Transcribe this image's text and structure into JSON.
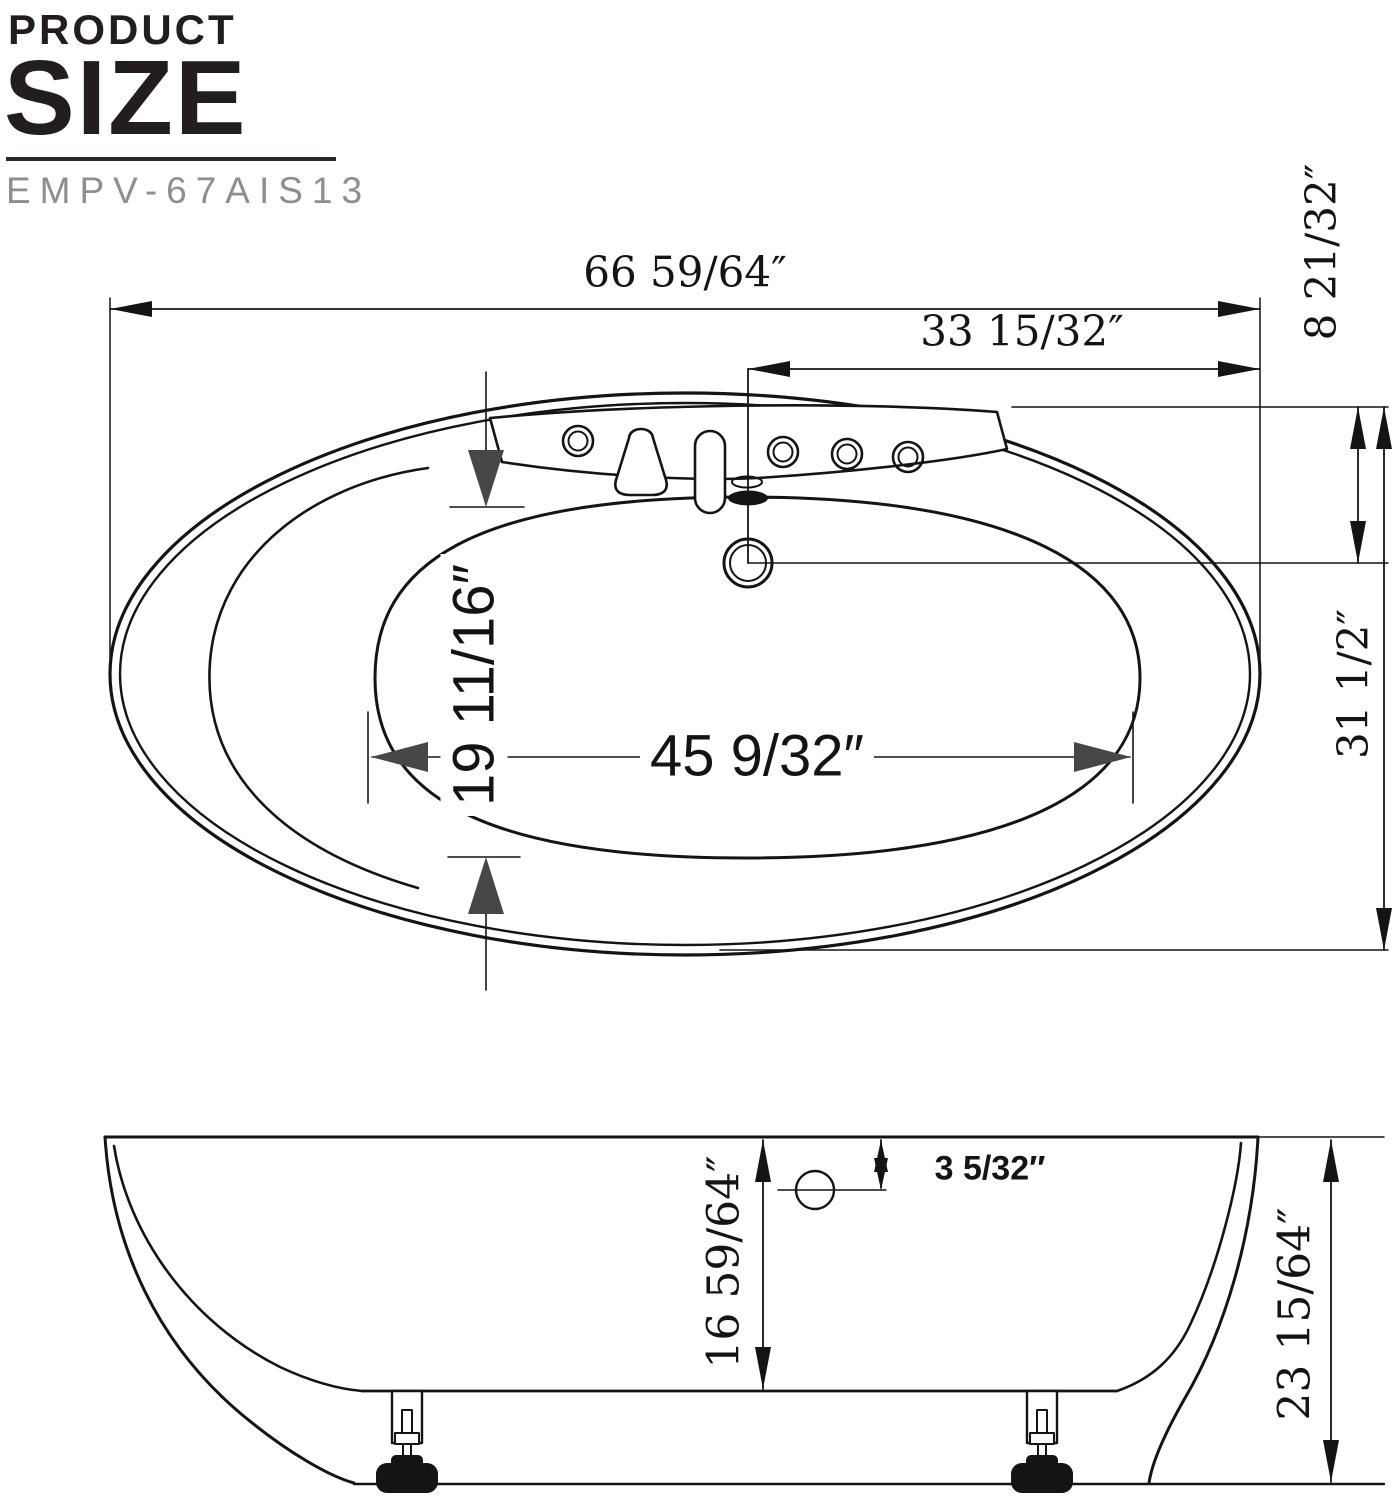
{
  "header": {
    "title_line1": "PRODUCT",
    "title_line2": "SIZE",
    "model": "EMPV-67AIS13"
  },
  "top_view": {
    "overall_length": "66 59/64″",
    "length_to_drain": "33 15/32″",
    "rim_to_drain": "8 21/32″",
    "overall_width": "31 1/2″",
    "basin_width": "19 11/16″",
    "basin_length": "45 9/32″"
  },
  "side_view": {
    "rim_to_drain_drop": "3 5/32″",
    "basin_depth": "16 59/64″",
    "overall_height": "23 15/64″"
  },
  "colors": {
    "line": "#141414",
    "heavy_arrow": "#474747",
    "title": "#231d1e",
    "model_gray": "#8e8e8e"
  }
}
